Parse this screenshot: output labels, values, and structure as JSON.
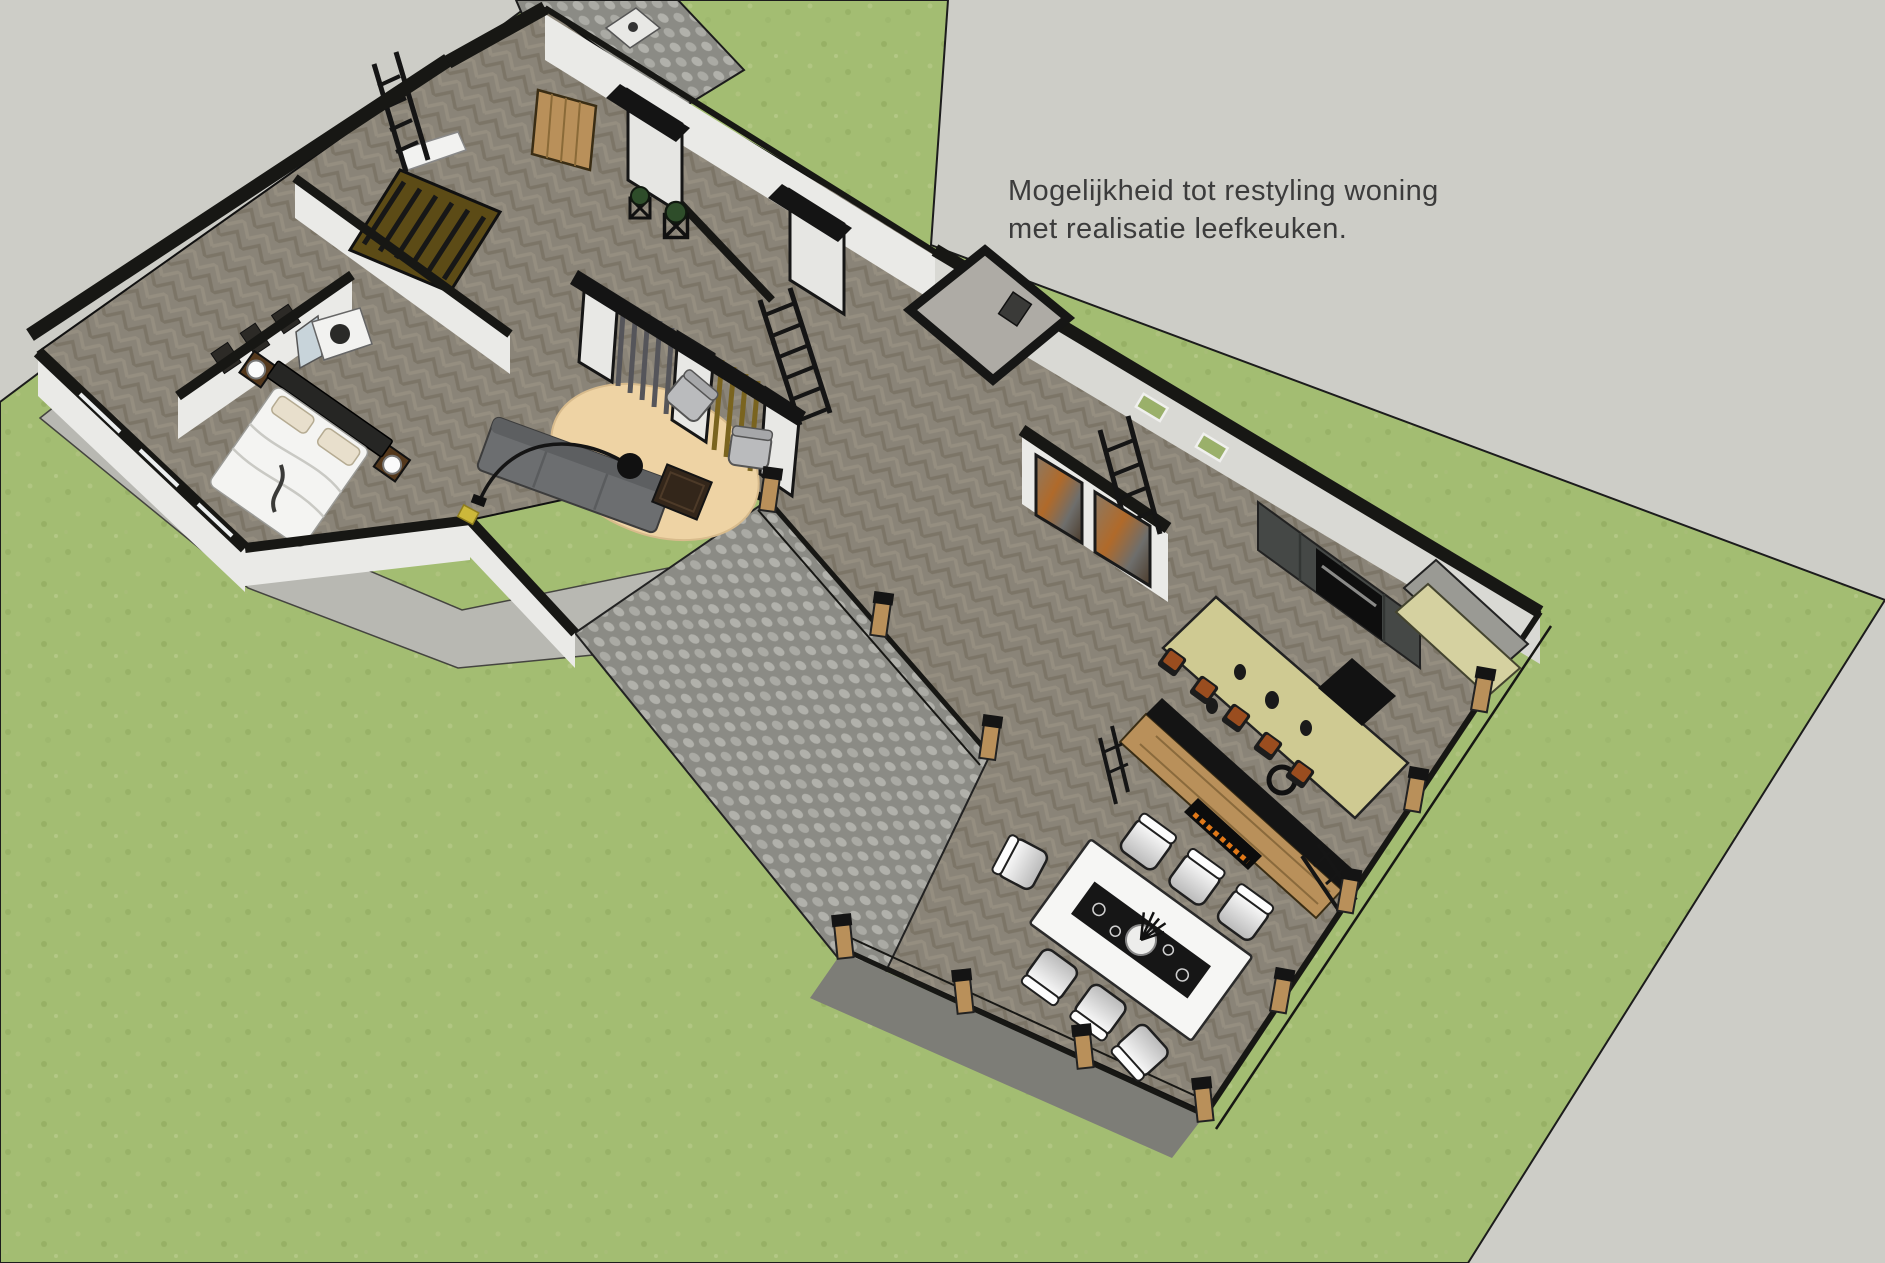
{
  "annotation": {
    "line1": "Mogelijkheid tot restyling woning",
    "line2": "met realisatie leefkeuken."
  },
  "palette": {
    "background": "#cdcdc7",
    "lawn": "#a3bd72",
    "pavement_joint": "#8b8b85",
    "apron": "#b8b8b2",
    "walkway": "#7d7d77",
    "floor": "#8a8478",
    "wall_black": "#171714",
    "wall_white": "#eaeae7",
    "wood": "#b9905a",
    "wardrobe": "#5c4b16",
    "island": "#cfca92",
    "bench": "#d5d1a0",
    "cabinets": "#454846",
    "stool_seat": "#9a4d1f",
    "rug": "#eed3a4",
    "sofa": "#6c6e70",
    "armchair": "#babbbd",
    "coffee_table": "#33261a",
    "bed_white": "#f4f4f2",
    "flame": "#e07818",
    "text": "#3c3c3c"
  }
}
